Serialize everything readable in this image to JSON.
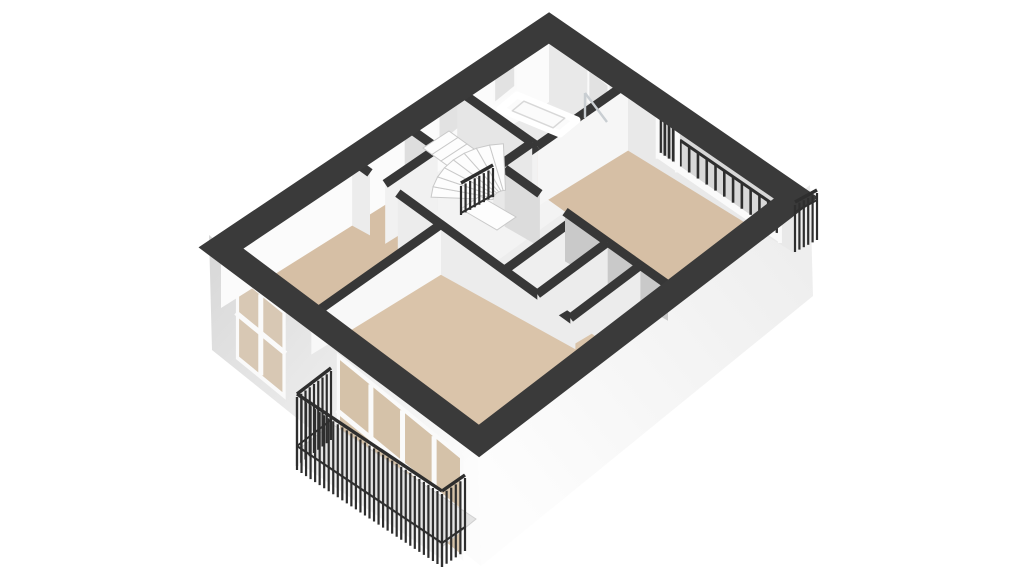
{
  "colors": {
    "background": "#ffffff",
    "band": "#3a3a3a",
    "wall_top": "#373737",
    "railing": "#2e2e2e",
    "floor_room": "#d6bfa5",
    "floor_living": "#dac4aa",
    "floor_hall": "#f3f3f3",
    "floor_bath": "#eaeaea",
    "floor_closet": "#ededed",
    "face_tl": "#fbfbfb",
    "face_tr": "#e9e9e9",
    "facade_bl_0": "#d7d7d7",
    "facade_bl_1": "#fcfcfc",
    "facade_br_0": "#fdfdfd",
    "facade_br_1": "#ececec",
    "glass_cool": "#e2e2e2",
    "glass_loggia": "#d8d8d8",
    "glass_warm": "#d5c2a9",
    "frame": "#fafafa",
    "step": "#fdfdfd",
    "step_edge": "#c9c9c9",
    "slab": "#e4e4e4",
    "slab_front": "#f1f1f1",
    "fixture": "#fbfbfb",
    "fixture_line": "#d8d8d8",
    "shower_glass": "#c9ced2"
  },
  "model": {
    "patch": {
      "T": [
        549,
        28
      ],
      "L": [
        221,
        248
      ],
      "R": [
        796,
        198
      ],
      "B": [
        479,
        441
      ]
    },
    "drops": {
      "T": 74,
      "L": 60,
      "R": 56,
      "B": 0
    },
    "band_width": 26,
    "facades": {
      "bl": [
        [
          209,
          235
        ],
        [
          478,
          455
        ],
        [
          481,
          566
        ],
        [
          212,
          350
        ]
      ],
      "br": [
        [
          478,
          455
        ],
        [
          810,
          185
        ],
        [
          813,
          296
        ],
        [
          481,
          566
        ]
      ]
    },
    "bl_edge": {
      "a": [
        209,
        235
      ],
      "b": [
        478,
        455
      ]
    },
    "bl_windows": [
      {
        "t0": 0.1,
        "t1": 0.285,
        "y0": 13,
        "y1": 102,
        "mull": [
          0.5
        ],
        "hmull": 0.48,
        "glass": "#d8c8b4"
      },
      {
        "t0": 0.475,
        "t1": 0.945,
        "y0": 13,
        "y1": 118,
        "mull": [
          0.27,
          0.52,
          0.77
        ],
        "hmull": 0.55,
        "glass": "#d5c2a9"
      }
    ],
    "floors": [
      {
        "name": "floor-hall",
        "rect": [
          0,
          0,
          1,
          1
        ],
        "fill": "#f3f3f3"
      },
      {
        "name": "floor-bathroom",
        "rect": [
          0,
          0,
          0.28,
          0.32
        ],
        "fill": "#eaeaea"
      },
      {
        "name": "floor-bedroom-left",
        "rect": [
          0.6,
          0,
          1,
          0.35
        ],
        "fill": "#d6bfa5"
      },
      {
        "name": "floor-living-room",
        "rect": [
          0.6,
          0.35,
          1,
          1
        ],
        "fill": "#dac4aa"
      },
      {
        "name": "floor-bedroom-right",
        "rect": [
          0,
          0.32,
          0.38,
          1
        ],
        "fill": "#d6bfa5"
      },
      {
        "name": "floor-closets",
        "rect": [
          0.38,
          0.56,
          0.6,
          1
        ],
        "fill": "#ededed"
      }
    ],
    "tl_windows": [
      {
        "u0": 0.1,
        "u1": 0.17,
        "y0": 6,
        "y1": 40
      },
      {
        "u0": 0.27,
        "u1": 0.34,
        "y0": 6,
        "y1": 44
      }
    ],
    "tr_bath_window": {
      "v0": 0.155,
      "v1": 0.245,
      "y0": 12,
      "y1": 48
    },
    "loggia": {
      "v0": 0.44,
      "v1": 0.935,
      "door_v": 0.515,
      "mullion_v": 0.52,
      "glass_top": 4,
      "sill_top": 48,
      "bottom": 56,
      "bars_main": 12,
      "bars_door": 4,
      "bar_top_main": 22,
      "bar_top_door": 10
    },
    "walls": [
      {
        "name": "wall-bath-west",
        "seg": [
          0.28,
          0.0,
          0.28,
          0.32
        ],
        "shade": "#e6e6e6"
      },
      {
        "name": "wall-bath-south",
        "seg": [
          0.0,
          0.32,
          0.28,
          0.32
        ],
        "shade": "#f6f6f6"
      },
      {
        "name": "wall-hall-stub",
        "seg": [
          0.28,
          0.32,
          0.34,
          0.32
        ],
        "shade": "#f2f2f2"
      },
      {
        "name": "wall-stairwell",
        "seg": [
          0.28,
          0.3,
          0.4,
          0.3
        ],
        "shade": "#e8e8e8"
      },
      {
        "name": "wall-closet-top-a",
        "seg": [
          0.44,
          0.0,
          0.44,
          0.13
        ],
        "shade": "#dedede"
      },
      {
        "name": "wall-closet-top-b",
        "seg": [
          0.44,
          0.13,
          0.6,
          0.13
        ],
        "shade": "#f1f1f1"
      },
      {
        "name": "wall-main-stub",
        "seg": [
          0.6,
          0.0,
          0.6,
          0.07
        ],
        "shade": "#ececec"
      },
      {
        "name": "wall-main",
        "seg": [
          0.6,
          0.18,
          0.6,
          0.88
        ],
        "shade": "#ececec"
      },
      {
        "name": "wall-bedl-living",
        "seg": [
          0.6,
          0.35,
          1.0,
          0.35
        ],
        "shade": "#f8f8f8"
      },
      {
        "name": "wall-bedr-hall-a",
        "seg": [
          0.38,
          0.32,
          0.38,
          0.46
        ],
        "shade": "#dcdcdc"
      },
      {
        "name": "wall-bedr-hall-b",
        "seg": [
          0.38,
          0.56,
          0.38,
          0.97
        ],
        "shade": "#c9c9c9"
      },
      {
        "name": "wall-closet-div-1",
        "seg": [
          0.38,
          0.6,
          0.6,
          0.6
        ],
        "shade": "#efefef"
      },
      {
        "name": "wall-closet-div-2",
        "seg": [
          0.38,
          0.73,
          0.6,
          0.73
        ],
        "shade": "#ececec"
      },
      {
        "name": "wall-closet-div-3",
        "seg": [
          0.38,
          0.86,
          0.6,
          0.86
        ],
        "shade": "#ececec"
      }
    ],
    "stairs": {
      "center": [
        506,
        200
      ],
      "r1": 13,
      "r2": 75,
      "deg0": 183,
      "deg1": 268,
      "n": 8,
      "squash": 0.75,
      "flight": {
        "start": [
          449,
          131
        ],
        "step": [
          9,
          6.5
        ],
        "depth": [
          -26,
          17
        ],
        "n": 4
      },
      "landing": [
        [
          480,
          196
        ],
        [
          516,
          217
        ],
        [
          497,
          230
        ],
        [
          461,
          209
        ]
      ],
      "railing": {
        "p0": [
          461,
          213
        ],
        "p1": [
          493,
          195
        ],
        "top": 30,
        "drop": 2
      }
    },
    "tub": {
      "outer": [
        [
          517,
          95
        ],
        [
          577,
          120
        ],
        [
          560,
          134
        ],
        [
          500,
          109
        ]
      ],
      "inner_scale": 0.68
    },
    "shower": {
      "lines": [
        [
          [
            585,
            93
          ],
          [
            607,
            122
          ]
        ],
        [
          [
            585,
            93
          ],
          [
            585,
            118
          ]
        ]
      ]
    },
    "balcony": {
      "slab": [
        [
          299,
          449
        ],
        [
          332,
          424
        ],
        [
          476,
          519
        ],
        [
          443,
          546
        ]
      ],
      "front": [
        [
          299,
          449
        ],
        [
          443,
          546
        ],
        [
          443,
          560
        ],
        [
          299,
          463
        ]
      ],
      "rails": [
        {
          "p0": [
            331,
            420
          ],
          "p1": [
            297,
            446
          ],
          "top": 52,
          "drop": 20
        },
        {
          "p0": [
            297,
            446
          ],
          "p1": [
            442,
            543
          ],
          "top": 52,
          "drop": 24
        },
        {
          "p0": [
            442,
            543
          ],
          "p1": [
            465,
            527
          ],
          "top": 52,
          "drop": 24
        }
      ]
    },
    "mini_rail": {
      "p0": [
        795,
        212
      ],
      "p1": [
        817,
        200
      ],
      "top": 10,
      "drop": 40
    }
  }
}
